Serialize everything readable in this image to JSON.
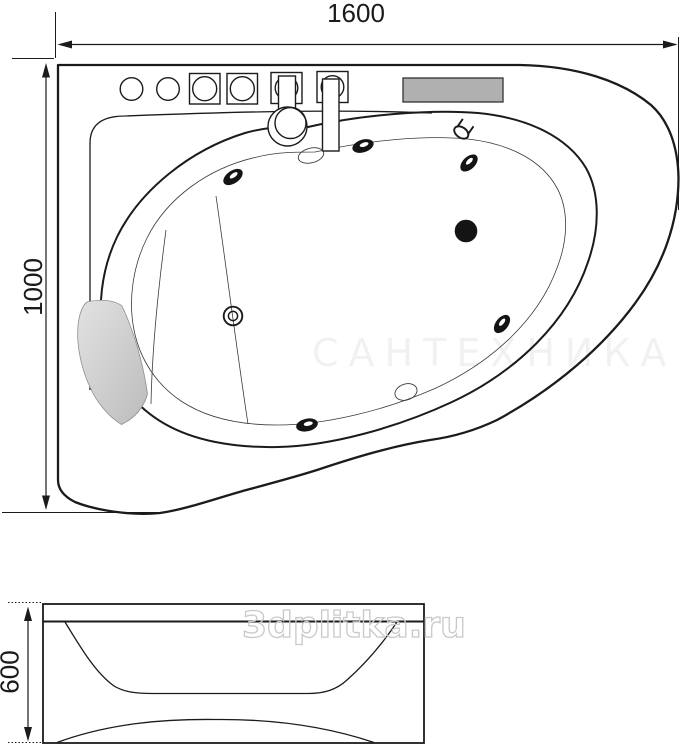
{
  "top_view": {
    "width_label": "1600",
    "height_label": "1000",
    "faint_watermark": "САНТЕХНИКА"
  },
  "side_view": {
    "height_label": "600",
    "watermark": "3dplitka.ru"
  },
  "colors": {
    "line": "#1b1b1b",
    "panel_gray": "#b0b0b0",
    "pillow_light": "#e2e2e2",
    "pillow_dark": "#bcbcbc",
    "watermark_outline": "#c9c9c9"
  }
}
